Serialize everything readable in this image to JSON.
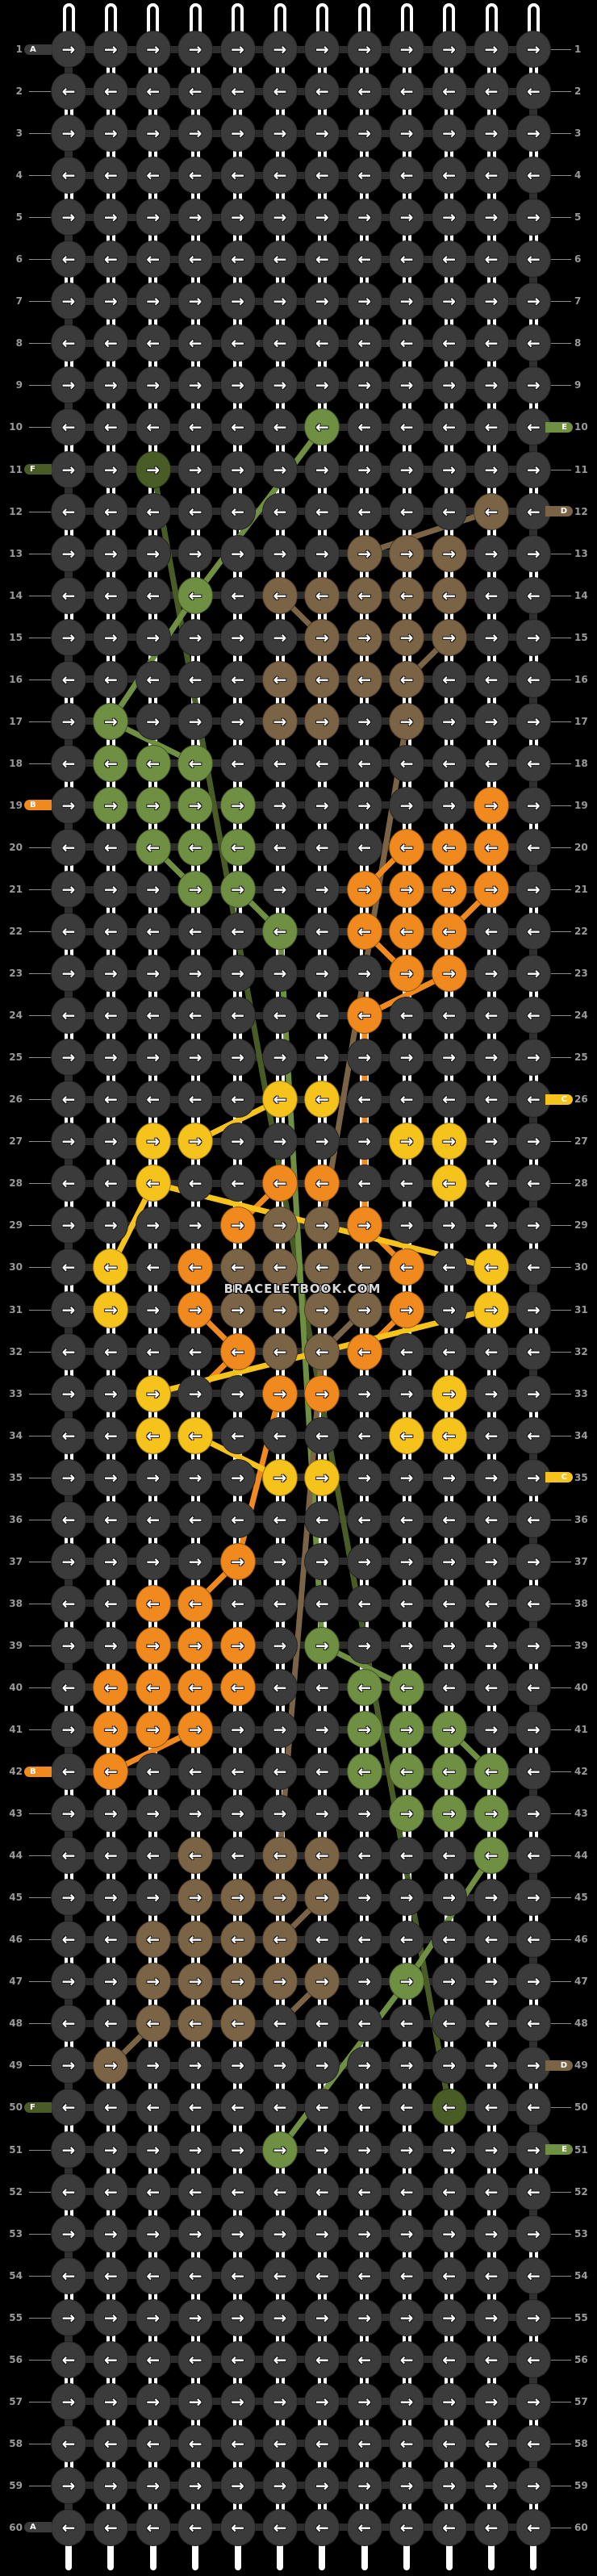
{
  "watermark": "BRACELETBOOK.COM",
  "pattern": {
    "rows": 60,
    "cols": 12,
    "arrow_pattern": {
      "odd_rows": "→",
      "even_rows": "←"
    },
    "colors": {
      "A": "#3b3b3b",
      "B": "#f18a1e",
      "C": "#f6c31d",
      "D": "#7b6345",
      "E": "#6f8f42",
      "F": "#4a5c26"
    },
    "color_names": {
      "A": "dark-gray",
      "B": "orange",
      "C": "yellow",
      "D": "brown",
      "E": "green",
      "F": "dark-green"
    },
    "knot_rows": [
      "............",
      "............",
      "............",
      "............",
      "............",
      "............",
      "............",
      "............",
      "............",
      "......E.....",
      "..F.........",
      "..........D.",
      ".......DDD..",
      "...E.DDDDD..",
      "......DDDD..",
      ".....DDDD...",
      ".E...DD.D...",
      ".EEE........",
      ".EEEE.....B.",
      "..EEE...BBB.",
      "...EE..BBBB.",
      ".....E.BBB..",
      "........BB..",
      ".......B....",
      "............",
      ".....CC.....",
      "..CC....CC..",
      "..C..BB..C..",
      "....BDDB....",
      ".C.BDDDDB.C.",
      ".C.BDDDDB.C.",
      "....BDDB....",
      "..C..BB..C..",
      "..CC....CC..",
      ".....CC.....",
      "............",
      "....B.......",
      "..BB........",
      "..BBB.E.....",
      ".BBBB..EE...",
      ".BBB...EEE..",
      ".B.....EEEE.",
      "........EEE.",
      "...D.DD...E.",
      "...DDDD.....",
      "..DDDD......",
      "..DDDDD.E...",
      "..DDD.......",
      ".D..........",
      ".........F..",
      ".....E......",
      "............",
      "............",
      "............",
      "............",
      "............",
      "............",
      "............",
      "............",
      "............"
    ],
    "left_ticks": [
      {
        "row": 1,
        "letter": "A"
      },
      {
        "row": 11,
        "letter": "F"
      },
      {
        "row": 19,
        "letter": "B"
      },
      {
        "row": 42,
        "letter": "B"
      },
      {
        "row": 50,
        "letter": "F"
      },
      {
        "row": 60,
        "letter": "A"
      }
    ],
    "right_ticks": [
      {
        "row": 10,
        "letter": "E"
      },
      {
        "row": 12,
        "letter": "D"
      },
      {
        "row": 26,
        "letter": "C"
      },
      {
        "row": 35,
        "letter": "C"
      },
      {
        "row": 49,
        "letter": "D"
      },
      {
        "row": 51,
        "letter": "E"
      }
    ],
    "string_segments": [
      {
        "color": "F",
        "from": [
          11,
          3
        ],
        "to": [
          50,
          10
        ]
      },
      {
        "color": "E",
        "from": [
          10,
          7
        ],
        "to": [
          14,
          4
        ]
      },
      {
        "color": "E",
        "from": [
          14,
          4
        ],
        "to": [
          17,
          2
        ]
      },
      {
        "color": "E",
        "from": [
          17,
          2
        ],
        "to": [
          18,
          4
        ]
      },
      {
        "color": "E",
        "from": [
          20,
          3
        ],
        "to": [
          21,
          4
        ]
      },
      {
        "color": "E",
        "from": [
          21,
          5
        ],
        "to": [
          22,
          6
        ]
      },
      {
        "color": "E",
        "from": [
          22,
          6
        ],
        "to": [
          39,
          7
        ]
      },
      {
        "color": "E",
        "from": [
          39,
          7
        ],
        "to": [
          40,
          9
        ]
      },
      {
        "color": "E",
        "from": [
          41,
          10
        ],
        "to": [
          42,
          11
        ]
      },
      {
        "color": "E",
        "from": [
          44,
          11
        ],
        "to": [
          47,
          9
        ]
      },
      {
        "color": "E",
        "from": [
          47,
          9
        ],
        "to": [
          51,
          6
        ]
      },
      {
        "color": "D",
        "from": [
          13,
          8
        ],
        "to": [
          12,
          11
        ]
      },
      {
        "color": "D",
        "from": [
          14,
          6
        ],
        "to": [
          15,
          7
        ]
      },
      {
        "color": "D",
        "from": [
          15,
          10
        ],
        "to": [
          16,
          9
        ]
      },
      {
        "color": "D",
        "from": [
          17,
          9
        ],
        "to": [
          29,
          7
        ]
      },
      {
        "color": "D",
        "from": [
          31,
          8
        ],
        "to": [
          32,
          7
        ]
      },
      {
        "color": "D",
        "from": [
          32,
          7
        ],
        "to": [
          44,
          6
        ]
      },
      {
        "color": "D",
        "from": [
          45,
          7
        ],
        "to": [
          46,
          6
        ]
      },
      {
        "color": "D",
        "from": [
          47,
          7
        ],
        "to": [
          48,
          6
        ]
      },
      {
        "color": "D",
        "from": [
          48,
          3
        ],
        "to": [
          49,
          2
        ]
      },
      {
        "color": "B",
        "from": [
          20,
          9
        ],
        "to": [
          21,
          8
        ]
      },
      {
        "color": "B",
        "from": [
          21,
          11
        ],
        "to": [
          22,
          10
        ]
      },
      {
        "color": "B",
        "from": [
          22,
          8
        ],
        "to": [
          23,
          9
        ]
      },
      {
        "color": "B",
        "from": [
          23,
          10
        ],
        "to": [
          24,
          8
        ]
      },
      {
        "color": "B",
        "from": [
          24,
          8
        ],
        "to": [
          29,
          8
        ]
      },
      {
        "color": "B",
        "from": [
          28,
          6
        ],
        "to": [
          29,
          5
        ]
      },
      {
        "color": "B",
        "from": [
          29,
          8
        ],
        "to": [
          30,
          9
        ]
      },
      {
        "color": "B",
        "from": [
          31,
          9
        ],
        "to": [
          32,
          8
        ]
      },
      {
        "color": "B",
        "from": [
          31,
          4
        ],
        "to": [
          32,
          5
        ]
      },
      {
        "color": "B",
        "from": [
          32,
          5
        ],
        "to": [
          33,
          4
        ]
      },
      {
        "color": "B",
        "from": [
          33,
          6
        ],
        "to": [
          37,
          5
        ]
      },
      {
        "color": "B",
        "from": [
          37,
          5
        ],
        "to": [
          38,
          4
        ]
      },
      {
        "color": "B",
        "from": [
          41,
          4
        ],
        "to": [
          42,
          2
        ]
      },
      {
        "color": "C",
        "from": [
          26,
          6
        ],
        "to": [
          27,
          4
        ]
      },
      {
        "color": "C",
        "from": [
          28,
          3
        ],
        "to": [
          30,
          2
        ]
      },
      {
        "color": "C",
        "from": [
          28,
          3
        ],
        "to": [
          30,
          11
        ]
      },
      {
        "color": "C",
        "from": [
          31,
          11
        ],
        "to": [
          33,
          3
        ]
      },
      {
        "color": "C",
        "from": [
          34,
          4
        ],
        "to": [
          35,
          6
        ]
      }
    ]
  }
}
